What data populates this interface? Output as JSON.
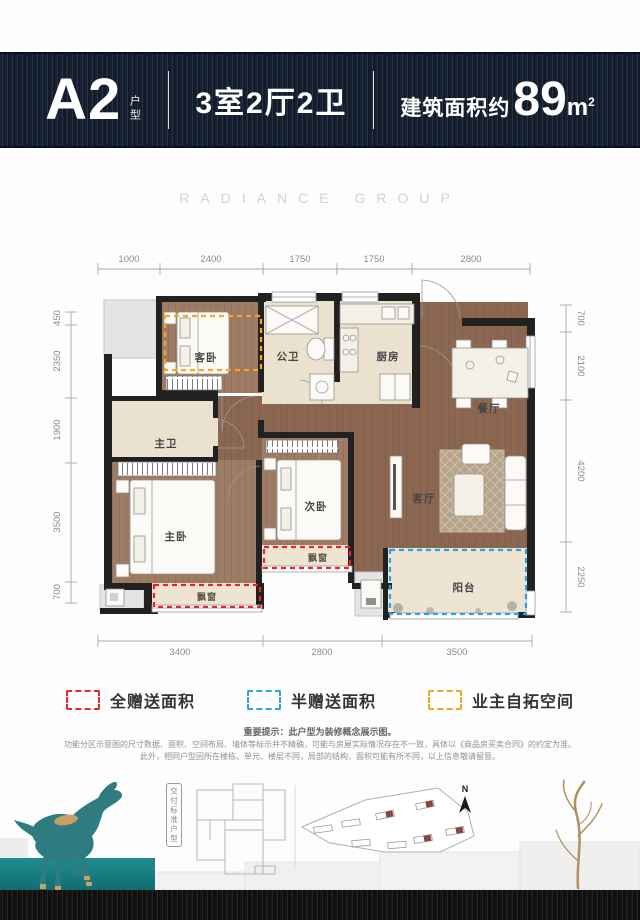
{
  "header": {
    "unit_code": "A2",
    "unit_suffix": "户型",
    "layout": "3室2厅2卫",
    "area_prefix": "建筑面积约",
    "area_value": "89",
    "area_unit": "m",
    "area_sup": "2"
  },
  "watermark": "RADIANCE GROUP",
  "floorplan": {
    "room_labels": {
      "guest_bedroom": "客卧",
      "public_bath": "公卫",
      "kitchen": "厨房",
      "dining": "餐厅",
      "master_bath": "主卫",
      "master_bedroom": "主卧",
      "second_bedroom": "次卧",
      "living": "客厅",
      "balcony": "阳台",
      "bay_window_master": "飘窗",
      "bay_window_second": "飘窗"
    },
    "dimensions": {
      "top": [
        "1000",
        "2400",
        "1750",
        "1750",
        "2800"
      ],
      "left": [
        "450",
        "2350",
        "1900",
        "3500",
        "700"
      ],
      "right": [
        "700",
        "2100",
        "4200",
        "2250"
      ],
      "bottom": [
        "3400",
        "2800",
        "3500"
      ]
    }
  },
  "legend": {
    "items": [
      {
        "label": "全赠送面积",
        "color": "#e8262c"
      },
      {
        "label": "半赠送面积",
        "color": "#29a3e3"
      },
      {
        "label": "业主自拓空间",
        "color": "#f5a623"
      }
    ]
  },
  "disclaimer": {
    "lines": [
      "重要提示：此户型为装修概念展示图。",
      "功能分区示意图的尺寸数据、面积、空间布局、墙体等标示并不精确，可能与房屋实际情况存在不一致，具体以《商品房买卖合同》的约定为准。",
      "此外，相同户型因所在楼栋、单元、楼层不同，局部的结构、面积可能有所不同，以上信息敬请留意。"
    ]
  },
  "footer": {
    "delivery_label": "交付标准户型",
    "compass": "N"
  },
  "colors": {
    "header_navy": "#17222f",
    "wall": "#212121",
    "wood_floor": "#8b6752",
    "wood_floor_light": "#9e7b64",
    "tile_beige": "#eae2cf",
    "bay_beige": "#ede5d2",
    "platform_gray": "#e4e4e4",
    "horse_teal": "#2e7c80",
    "gold": "#c9a063",
    "full_gift_red": "#e8262c",
    "half_gift_blue": "#29a3e3",
    "owner_expand_orange": "#f5a623"
  }
}
